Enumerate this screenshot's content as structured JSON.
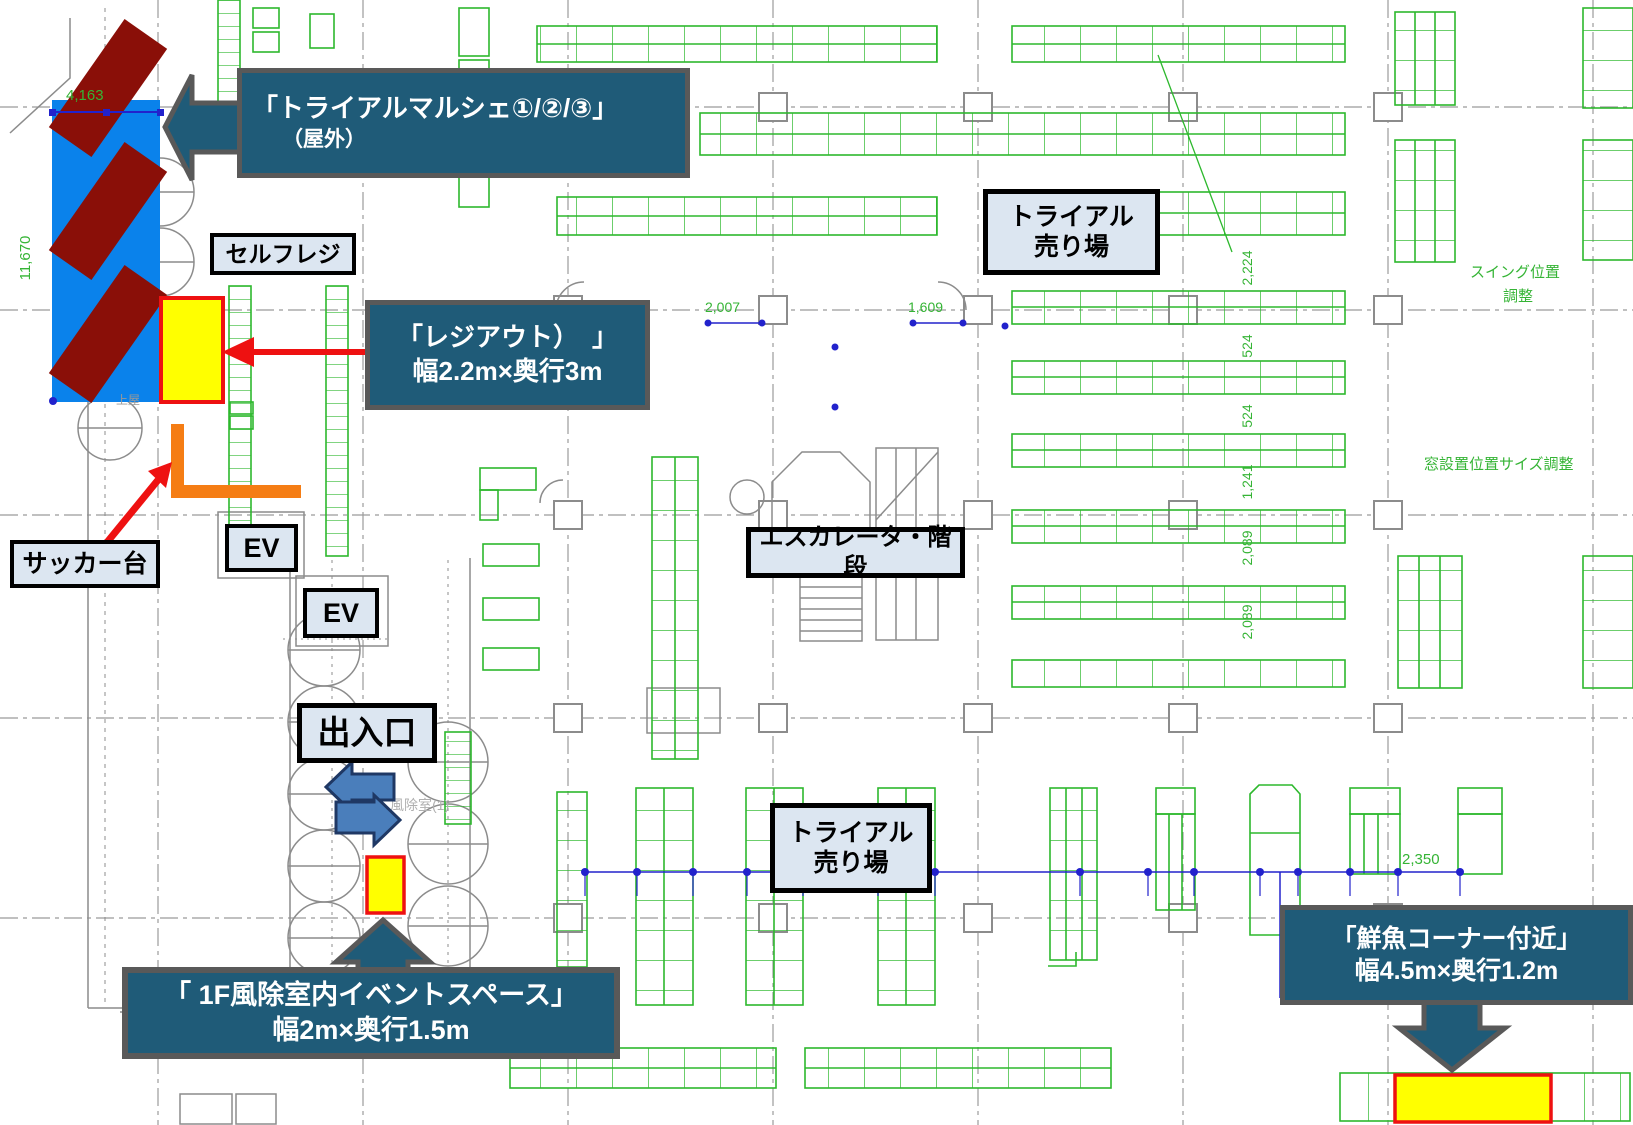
{
  "colors": {
    "callout_bg": "#1f5b78",
    "callout_border": "#595959",
    "label_bg": "#dce6f1",
    "label_border": "#000000",
    "plan_green": "#2db82d",
    "plan_gray": "#8c8c8c",
    "dim_blue": "#2222cc",
    "highlight_yellow": "#ffff00",
    "highlight_border_red": "#ee1111",
    "zone_blue": "#0a82eb",
    "zone_maroon": "#8a0f08",
    "zone_orange": "#f57d14",
    "door_arrow_blue": "#4a7ebb",
    "door_arrow_border": "#1f3864",
    "red_arrow": "#ee1111"
  },
  "callouts": {
    "marche": {
      "line1": "「トライアルマルシェ①/②/③」",
      "line2": "（屋外）"
    },
    "regi_out": {
      "line1": "「レジアウト）　」",
      "line2": "幅2.2m×奥行3m"
    },
    "event_space": {
      "line1": "「 1F風除室内イベントスペース」",
      "line2": "幅2m×奥行1.5m"
    },
    "fresh_fish": {
      "line1": "「鮮魚コーナー付近」",
      "line2": "幅4.5m×奥行1.2m"
    }
  },
  "labels": {
    "self_checkout": "セルフレジ",
    "sacker_table": "サッカー台",
    "elevator_upper": "EV",
    "elevator_lower": "EV",
    "entrance": "出入口",
    "escalator_stairs": "エスカレータ・階段",
    "sales_floor_upper": {
      "line1": "トライアル",
      "line2": "売り場"
    },
    "sales_floor_lower": {
      "line1": "トライアル",
      "line2": "売り場"
    }
  },
  "plan_texts": {
    "dim_top_left_width": "4,163",
    "dim_left_height": "11,670",
    "dim_aisle_left": "2,007",
    "dim_aisle_right": "1,609",
    "dim_right_1": "2,224",
    "dim_right_2": "524",
    "dim_right_3": "524",
    "dim_right_4": "1,241",
    "dim_right_5": "2,089",
    "dim_right_6": "2,089",
    "dim_bottom_right": "2,350",
    "note_swing_1": "スイング位置",
    "note_swing_2": "調整",
    "note_window": "窓設置位置サイズ調整",
    "room_vestibule": "風除室(1)",
    "note_canopy": "上屋"
  }
}
